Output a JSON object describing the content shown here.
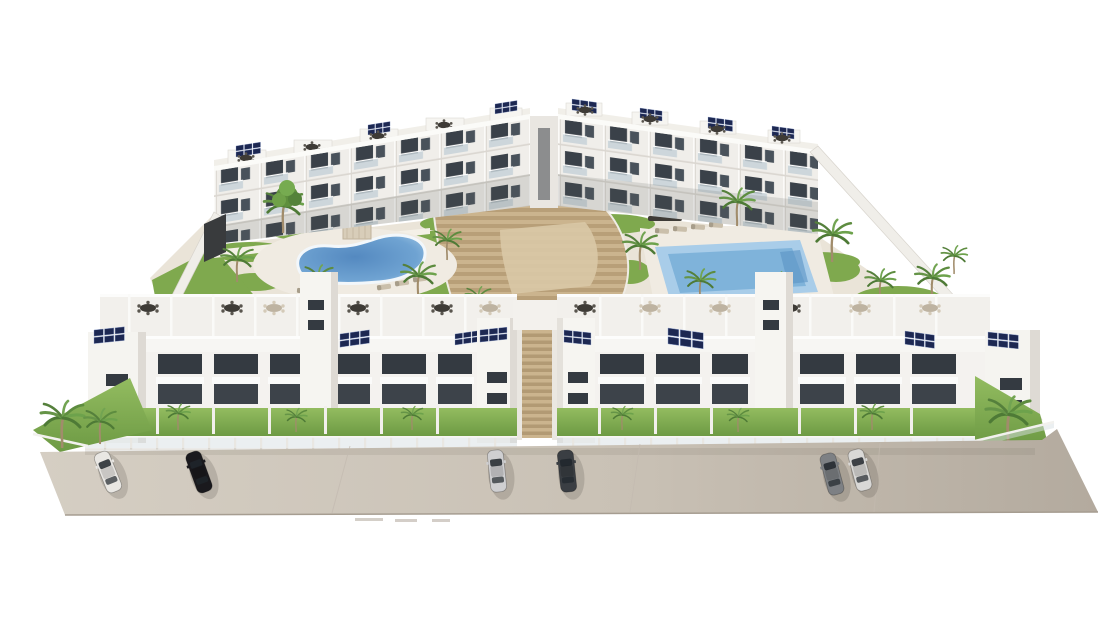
{
  "scene": {
    "title": "Aerial 3D architectural rendering of a new-build white residential complex: two rear apartment blocks and two front townhouse rows around a landscaped courtyard with a kidney-shaped pool, a rectangular pool and a terraced amphitheater staircase; rooftop terraces with furniture and solar panels; palm trees; cars parked on the beige street in front",
    "type": "architectural-render",
    "background_color": "#ffffff",
    "palette": {
      "pavement_light": "#d3ccc1",
      "pavement_dark": "#b3aa9e",
      "pavement_edge": "#a69d91",
      "building_white": "#f6f5f2",
      "building_shade": "#ece9e4",
      "building_side": "#d9d5cf",
      "window_dark": "#343a41",
      "opening_dark": "#3d434a",
      "glass_railing": "#c7d2d9",
      "solar_panel": "#1d2852",
      "solar_grid": "#8fa2cf",
      "lawn_mid": "#7fa94e",
      "lawn_dark": "#5e8a3c",
      "palm_green": "#55803c",
      "palm_green_light": "#6da24c",
      "palm_trunk": "#a18c6b",
      "pool_water_deep": "#5489c0",
      "pool_water_mid": "#7fb3da",
      "pool_water_light": "#a9cde9",
      "pool_deck": "#f0ebe2",
      "steps_light": "#cbb48e",
      "steps_dark": "#b89f78",
      "furniture_dark": "#3e3b36",
      "furniture_beige": "#beb3a1",
      "wall_white": "#f0eee9"
    },
    "site": {
      "rear_apartment_blocks": 2,
      "front_townhouse_blocks": 2,
      "floors_rear_blocks": 3,
      "pools": [
        {
          "shape": "kidney",
          "location": "left courtyard"
        },
        {
          "shape": "rectangular",
          "location": "right courtyard"
        }
      ],
      "central_feature": "terraced amphitheater staircase between the blocks",
      "rooftop_features": [
        "solar panel arrays",
        "roof terraces with outdoor dining furniture",
        "pergola posts"
      ],
      "landscaping": [
        "palm trees",
        "lawn patches",
        "sun loungers",
        "pergolas"
      ],
      "boundary": "white perimeter walls with glass balustrade fencing",
      "solar_array_count": 15,
      "palm_count_approx": 25
    },
    "street": {
      "surface": "beige pavement / roadway across the foreground",
      "cars": [
        {
          "color_name": "white",
          "color": "#e9e7e3"
        },
        {
          "color_name": "black",
          "color": "#1a191d"
        },
        {
          "color_name": "silver",
          "color": "#cfcfd1"
        },
        {
          "color_name": "dark-gray",
          "color": "#3a3e43"
        },
        {
          "color_name": "gray",
          "color": "#7d8084"
        },
        {
          "color_name": "silver-white",
          "color": "#d9d8d6"
        }
      ]
    }
  }
}
